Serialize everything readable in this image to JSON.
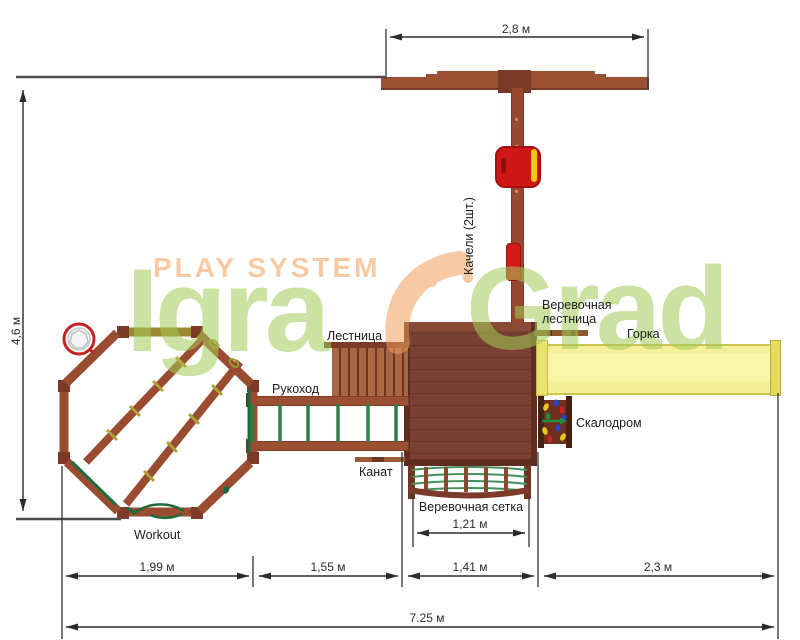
{
  "watermark": {
    "play_system": "PLAY SYSTEM",
    "igra": "Igra",
    "grad": "Grad"
  },
  "labels": {
    "swings": "Качели (2шт.)",
    "ladder": "Лестница",
    "rope_ladder": "Веревочная лестница",
    "slide": "Горка",
    "monkey_bars": "Рукоход",
    "climbing_wall": "Скалодром",
    "rope": "Канат",
    "rope_net": "Веревочная сетка",
    "workout": "Workout"
  },
  "dimensions": {
    "top_width": "2,8 м",
    "left_height": "4,6 м",
    "bottom_segment_1": "1,99 м",
    "bottom_segment_2": "1,55 м",
    "bottom_segment_3": "1,41 м",
    "bottom_segment_4": "2,3 м",
    "total_width": "7.25 м",
    "net_width": "1,21 м"
  },
  "colors": {
    "wood_brown": "#9a4c31",
    "wood_dark": "#7a3b28",
    "deck_brown": "#794033",
    "swing_red": "#cf1717",
    "accent_yellow": "#f2c80a",
    "slide_yellow": "#f0ea82",
    "rung_green": "#2f7d45",
    "net_green": "#43905d",
    "watermark_green": "#a4cc57",
    "watermark_peach": "#f2a05c",
    "dimension_line": "#2b2b2b",
    "hoop_red": "#c32222"
  }
}
